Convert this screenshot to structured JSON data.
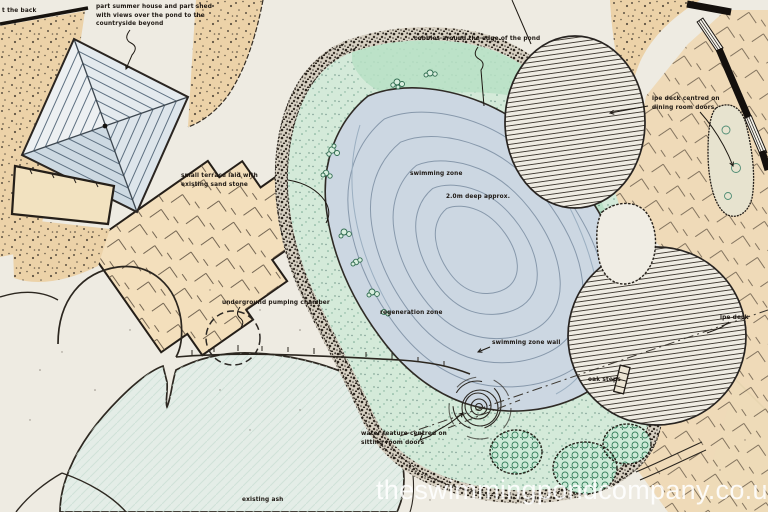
{
  "title": "hand-drawn swimming pond landscape plan",
  "watermark": "theswimmingpondcompany.co.uk",
  "labels": {
    "back": "t the back",
    "summer_house": "part summer house and part shed\nwith views over the pond to the\ncountryside beyond",
    "cobbles": "cobbles around the edge of the pond",
    "ipe_deck_dining": "ipe deck centred on\ndining room doors",
    "terrace": "small terrace laid with\nexisting sand stone",
    "swimming_zone": "swimming zone",
    "depth": "2.0m deep approx.",
    "pumping_chamber": "underground pumping chamber",
    "regeneration_zone": "regeneration zone",
    "swimming_zone_wall": "swimming zone wall",
    "oak_steps": "oak steps",
    "ipe_deck": "ipe deck",
    "water_feature": "water feature centred on\nsitting room doors",
    "existing_ash": "existing ash"
  },
  "colors": {
    "paper": "#ece8df",
    "ink": "#241f19",
    "sandstone": "#f3dfbc",
    "gravel": "#ecd2a8",
    "pond_water": "#ccd7e2",
    "regeneration_green": "#d4ead9",
    "shrub_green": "#cdeAD8",
    "cobble": "#d7d0c2",
    "roof_blue": "#cdd9e2",
    "wall_black": "#14100d",
    "watermark_white": "#ffffff"
  }
}
